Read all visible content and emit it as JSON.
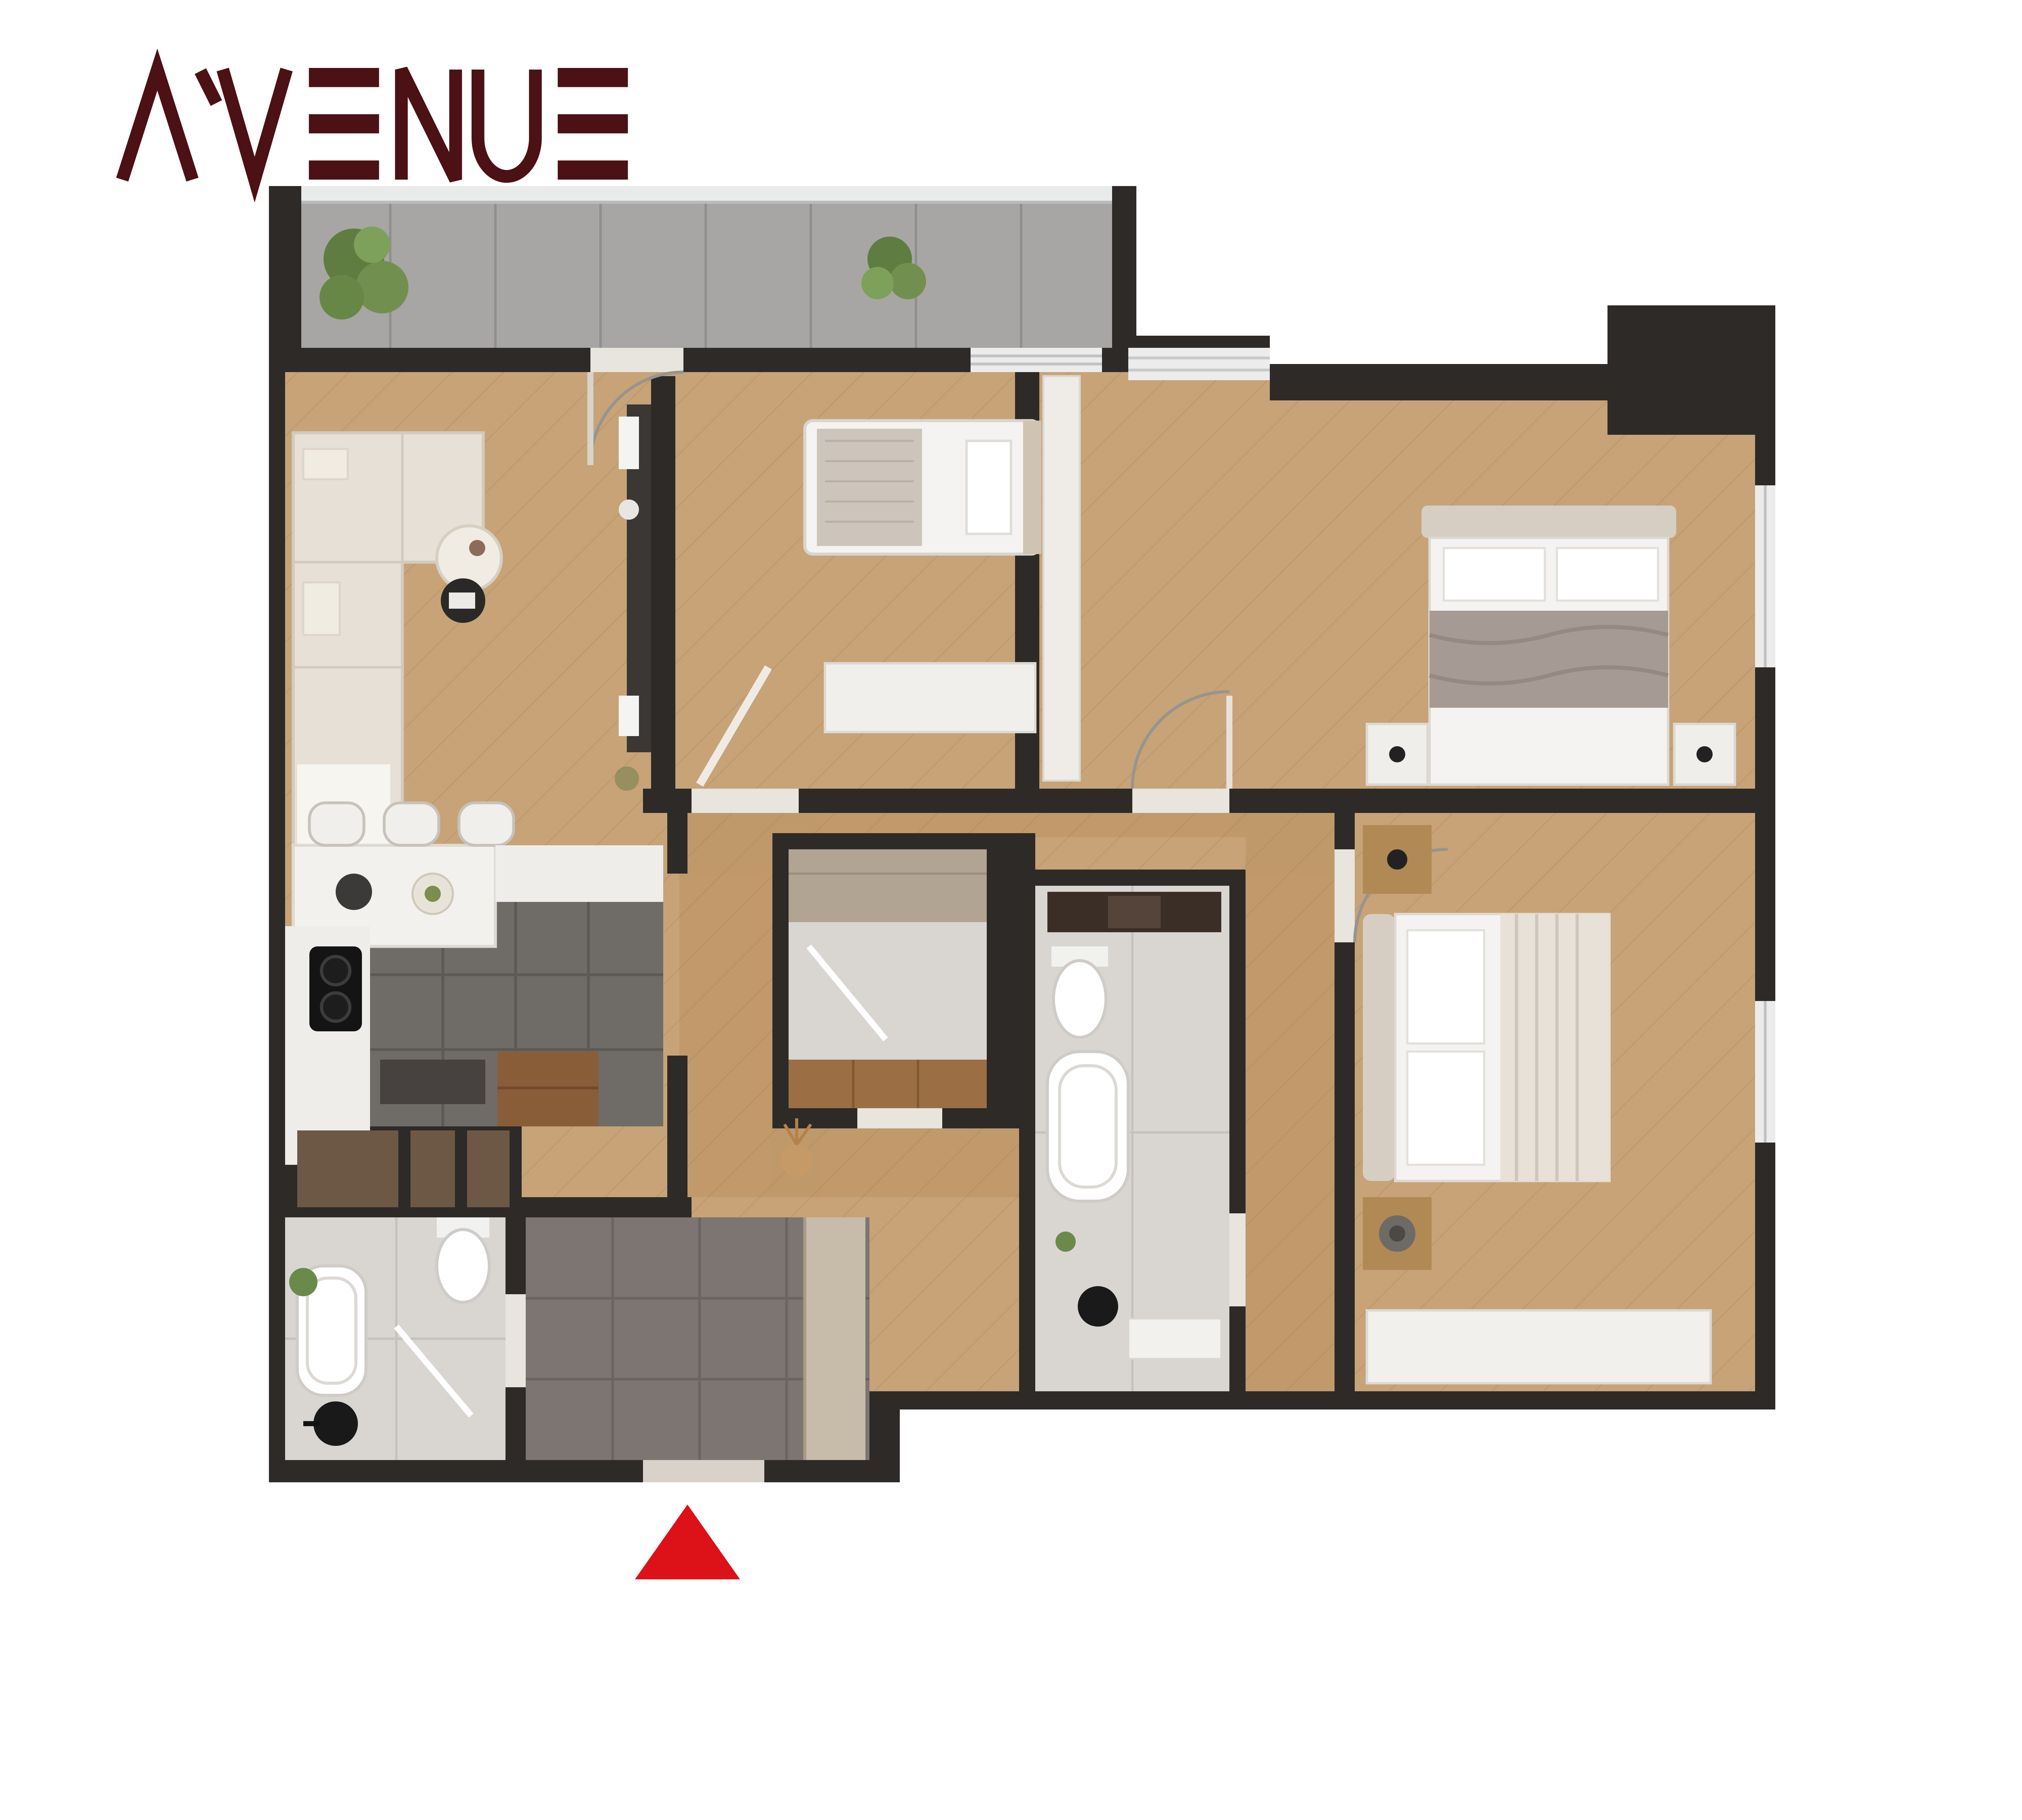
{
  "logo": {
    "brand": "AVENUE",
    "subtitle": "Davtashen",
    "brand_color": "#4b1114",
    "subtitle_color": "#3e3d41"
  },
  "panel": {
    "bg_color": "#8CA264",
    "area_title": "109.6 մ²",
    "rooms_title": "4 սենյակ",
    "rooms": [
      {
        "label": "1.Միջանցք 1",
        "area": "7,61մ²"
      },
      {
        "label": "2.Միջանցք 2",
        "area": "12,65մ²"
      },
      {
        "label": "3.Ընդ. սենյակ",
        "area": "13,98մ²"
      },
      {
        "label": "4.Խոհանոց",
        "area": "12,82մ²"
      },
      {
        "label": "5.Սանհանգույց 1",
        "area": "4,74մ²"
      },
      {
        "label": "6.Սանհանգույց 2",
        "area": "4,75մ²"
      },
      {
        "label": "7.Ննջասենյակ 1",
        "area": "9,12մ²"
      },
      {
        "label": "8.Ննջասենյակ 2",
        "area": "17,14մ²"
      },
      {
        "label": "9.Ննջասենյակ 3",
        "area": "15,52մ²"
      },
      {
        "label": "10.Խորրդանոց",
        "area": "5,19մ²"
      },
      {
        "label": "11.Պատշգամբ",
        "area": "6,08մ²"
      }
    ]
  },
  "floorplan": {
    "entrance_marker_color": "#DD1118",
    "wall_color": "#2d2a28",
    "wood_color": "#c7a377",
    "highlight_unit_color": "#9A7A52",
    "column_marker_color": "#C0181C"
  }
}
